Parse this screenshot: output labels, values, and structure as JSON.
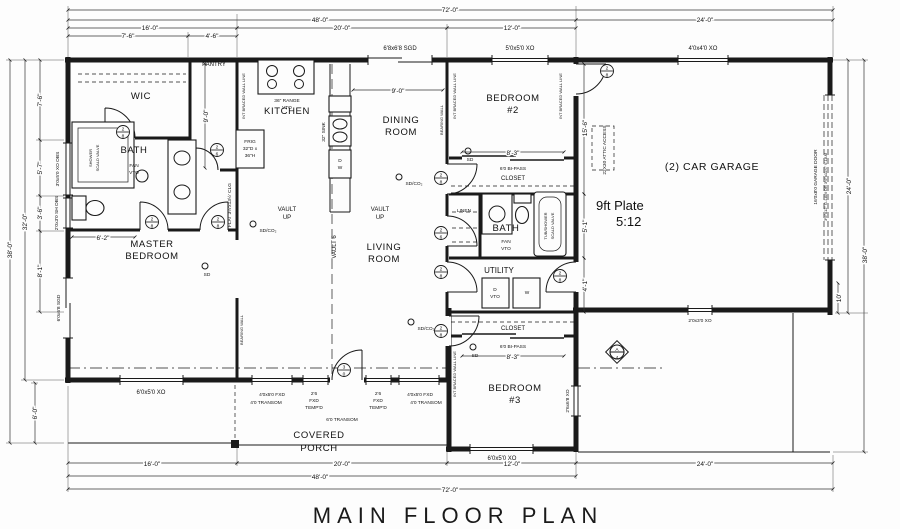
{
  "title": "MAIN FLOOR PLAN",
  "rooms": {
    "wic": "WIC",
    "pantry": "PANTRY",
    "kitchen": "KITCHEN",
    "bath": "BATH",
    "master1": "MASTER",
    "master2": "BEDROOM",
    "dining1": "DINING",
    "dining2": "ROOM",
    "living1": "LIVING",
    "living2": "ROOM",
    "bedroom": "BEDROOM",
    "bed2num": "#2",
    "bed3num": "#3",
    "utility": "UTILITY",
    "garage": "(2) CAR GARAGE",
    "porch1": "COVERED",
    "porch2": "PORCH",
    "closet": "CLOSET",
    "linen": "LINEN"
  },
  "notes": {
    "plate": "9ft Plate",
    "pitch": "5:12",
    "vault": "VAULT",
    "up": "UP",
    "vault_line": "VAULT 6",
    "flat_clg": "FLAT 3½'x13½' CLG",
    "attic": "22X30 ATTIC ACCESS",
    "garage_door": "16'0x8'0 GARAGE DOOR",
    "glam": "3½\"x12\" G-LAM OR 3½\"x11⅞\" V-LAM",
    "braced": "INT BRACED WALL LINE",
    "bearing": "BEARING WALL",
    "sdco": "SD/CO₂",
    "sd": "SD",
    "sec_top": "A",
    "sec_bot": "4"
  },
  "fixtures": {
    "range1": "36\" RANGE",
    "range2": "VTO",
    "frig1": "FRIG",
    "frig2": "32\"D x",
    "frig3": "36\"H",
    "sink": "32\" SINK",
    "d": "D",
    "w": "W",
    "vto": "VTO",
    "fan1": "FAN",
    "fan2": "VTO",
    "shower1": "SHOWER",
    "shower2": "SCALD VALVE",
    "tub1": "TUB/SHOWER",
    "tub2": "SCALD VALVE"
  },
  "windows": {
    "sgd_top": "6'8x6'8 SGD",
    "xo55": "5'0x5'0 XO",
    "xo44": "4'0x4'0 XO",
    "xo_obs": "3'0x5'0 XO OBS",
    "sh_obs": "2'0x3'0 SH OBS",
    "sgd_master": "6'0x6'8 SGD",
    "xo65": "6'0x5'0 XO",
    "fxd45": "4'0x5'0 FXD",
    "tr4": "4'0 TRANSOM",
    "f26a": "2'6",
    "f26b": "FXD",
    "f26c": "TEMP'D",
    "tr6": "6'0 TRANSOM",
    "xo_b3side": "2'6x6'8 XO",
    "xo23": "2'0x3'0 XO",
    "bipass": "6'0 BI-PASS"
  },
  "doors": {
    "d28t": "2",
    "d28b": "8",
    "d26t": "2",
    "d26b": "6",
    "d30t": "3",
    "d30b": "0"
  },
  "dims": {
    "t72": "72'-0\"",
    "t48": "48'-0\"",
    "t24": "24'-0\"",
    "t16": "16'-0\"",
    "t20": "20'-0\"",
    "t12": "12'-0\"",
    "t76": "7'-6\"",
    "t46": "4'-6\"",
    "l57": "5'-7\"",
    "l36": "3'-6\"",
    "l81": "8'-1\"",
    "l32": "32'-0\"",
    "l38": "38'-0\"",
    "p6": "6'-0\"",
    "r10": "10'",
    "b156": "15'-6\"",
    "b51": "5'-1\"",
    "b41": "4'-1\"",
    "din9": "9'-0\"",
    "cl83": "8'-3\"",
    "m62": "6'-2\"",
    "pan9": "9'-0\""
  }
}
